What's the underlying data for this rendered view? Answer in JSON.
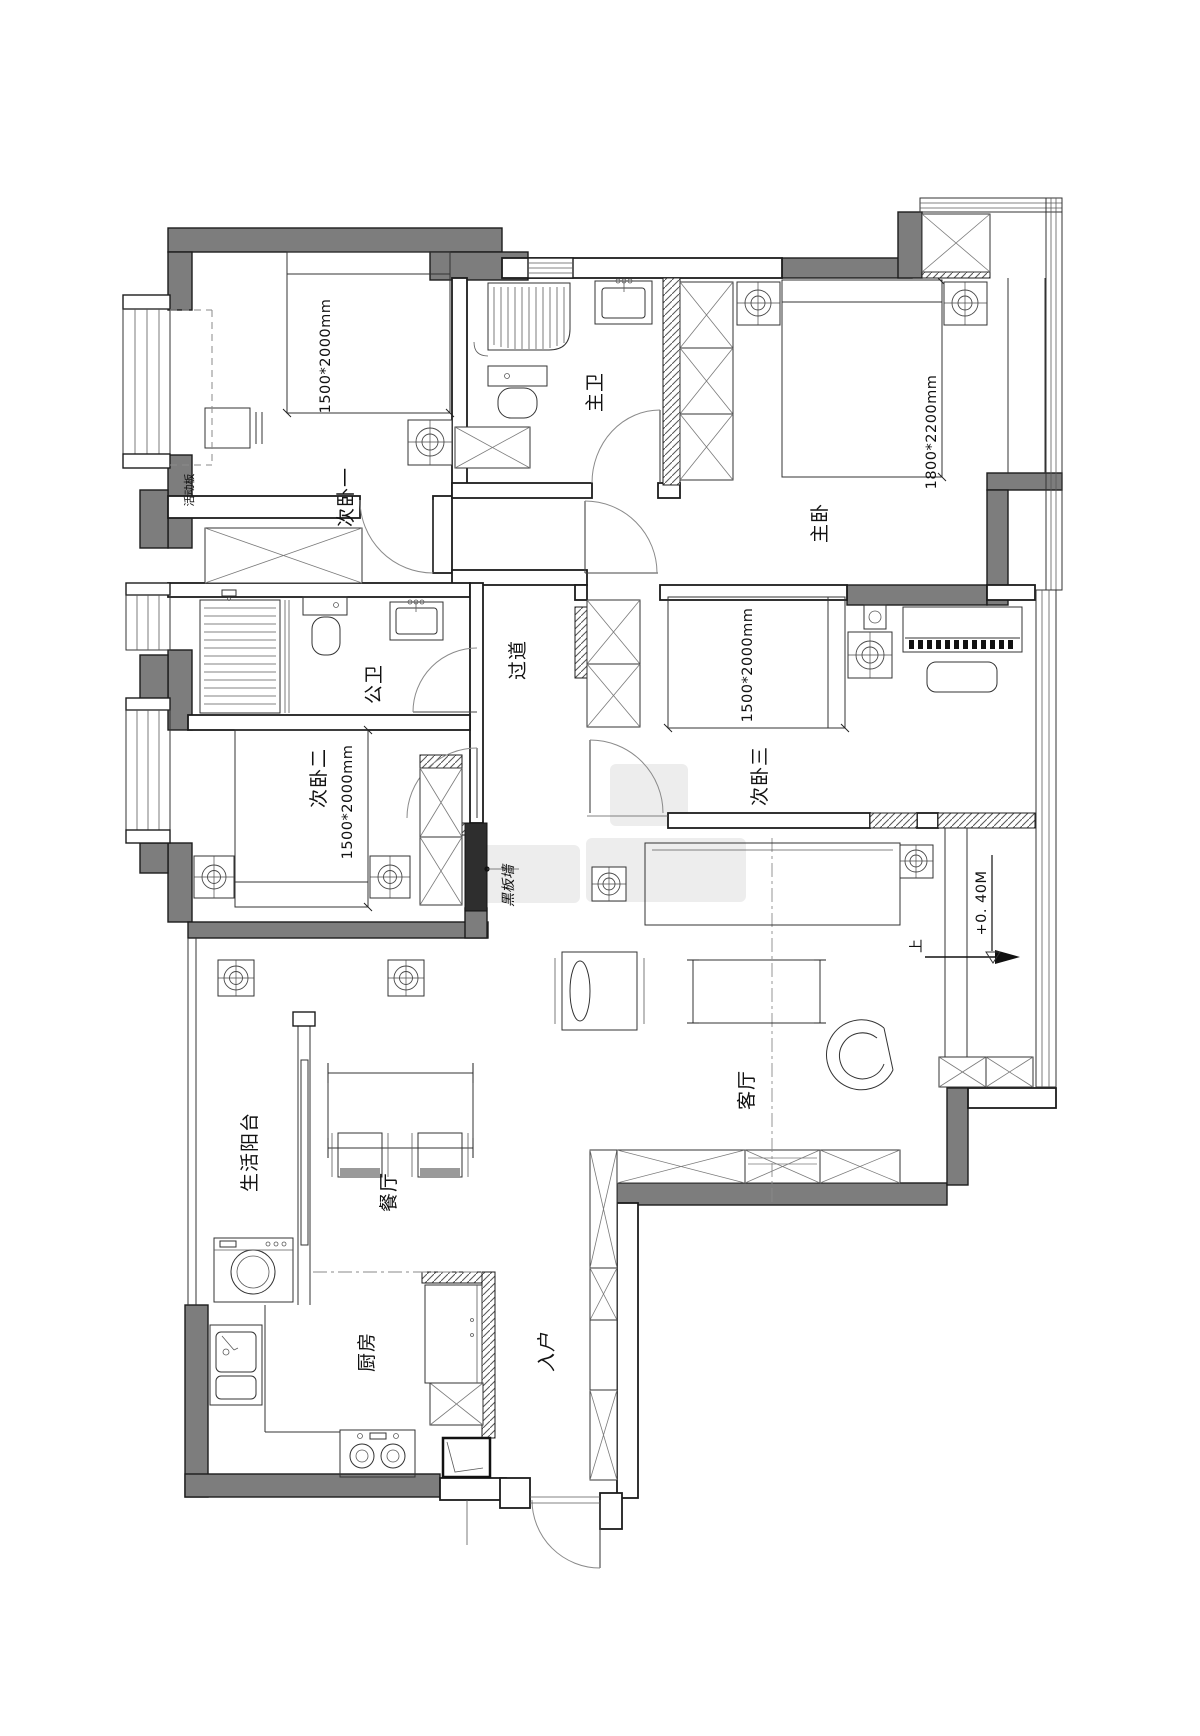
{
  "plan": {
    "rooms": {
      "bedroom_1": {
        "name": "次卧一",
        "bed_size": "1500*2000mm",
        "movable_panel": "活动板"
      },
      "master_bathroom": {
        "name": "主卫"
      },
      "master_bedroom": {
        "name": "主卧",
        "bed_size": "1800*2200mm"
      },
      "public_bathroom": {
        "name": "公卫"
      },
      "hallway": {
        "name": "过道"
      },
      "bedroom_2": {
        "name": "次卧二",
        "bed_size": "1500*2000mm"
      },
      "bedroom_3": {
        "name": "次卧三",
        "bed_size": "1500*2000mm"
      },
      "living_room": {
        "name": "客厅",
        "feature_wall": "黑板墙",
        "floor_level": "+0. 40M",
        "step_direction": "上"
      },
      "service_balcony": {
        "name": "生活阳台"
      },
      "dining_room": {
        "name": "餐厅"
      },
      "kitchen": {
        "name": "厨房"
      },
      "entry": {
        "name": "入户"
      }
    },
    "colors": {
      "wall_fill": "#7d7d7d",
      "feature_wall": "#2e2e2e",
      "line": "#1c1c1c",
      "background": "#ffffff"
    }
  }
}
